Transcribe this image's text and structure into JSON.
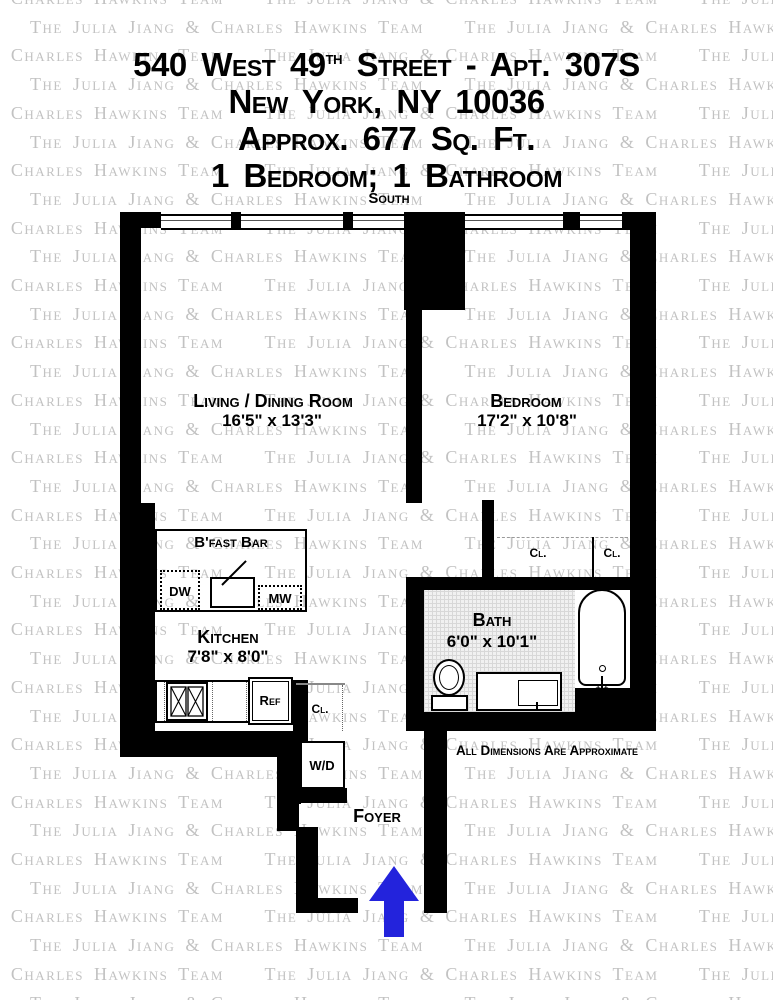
{
  "watermark": {
    "phrase": "The Julia Jiang & Charles Hawkins Team"
  },
  "header": {
    "address_prefix": "540 West 49",
    "address_sup": "th",
    "address_suffix": " Street - Apt. 307S",
    "city": "New York, NY 10036",
    "area": "Approx. 677 Sq. Ft.",
    "config": "1 Bedroom; 1 Bathroom"
  },
  "plan": {
    "orientation_label": "South",
    "rooms": {
      "living": {
        "name": "Living / Dining Room",
        "dims": "16'5\" x 13'3\""
      },
      "bedroom": {
        "name": "Bedroom",
        "dims": "17'2\" x 10'8\""
      },
      "kitchen": {
        "name": "Kitchen",
        "dims": "7'8\" x 8'0\""
      },
      "bath": {
        "name": "Bath",
        "dims": "6'0\" x 10'1\""
      },
      "foyer": {
        "name": "Foyer"
      }
    },
    "features": {
      "bfast_bar": "B'fast Bar",
      "dw": "DW",
      "mw": "MW",
      "ref": "Ref",
      "wd": "W/D",
      "closet": "Cl.",
      "tub_faucet_marks": "+ +"
    },
    "note": "All Dimensions Are Approximate",
    "arrow_color": "#2323dc"
  }
}
